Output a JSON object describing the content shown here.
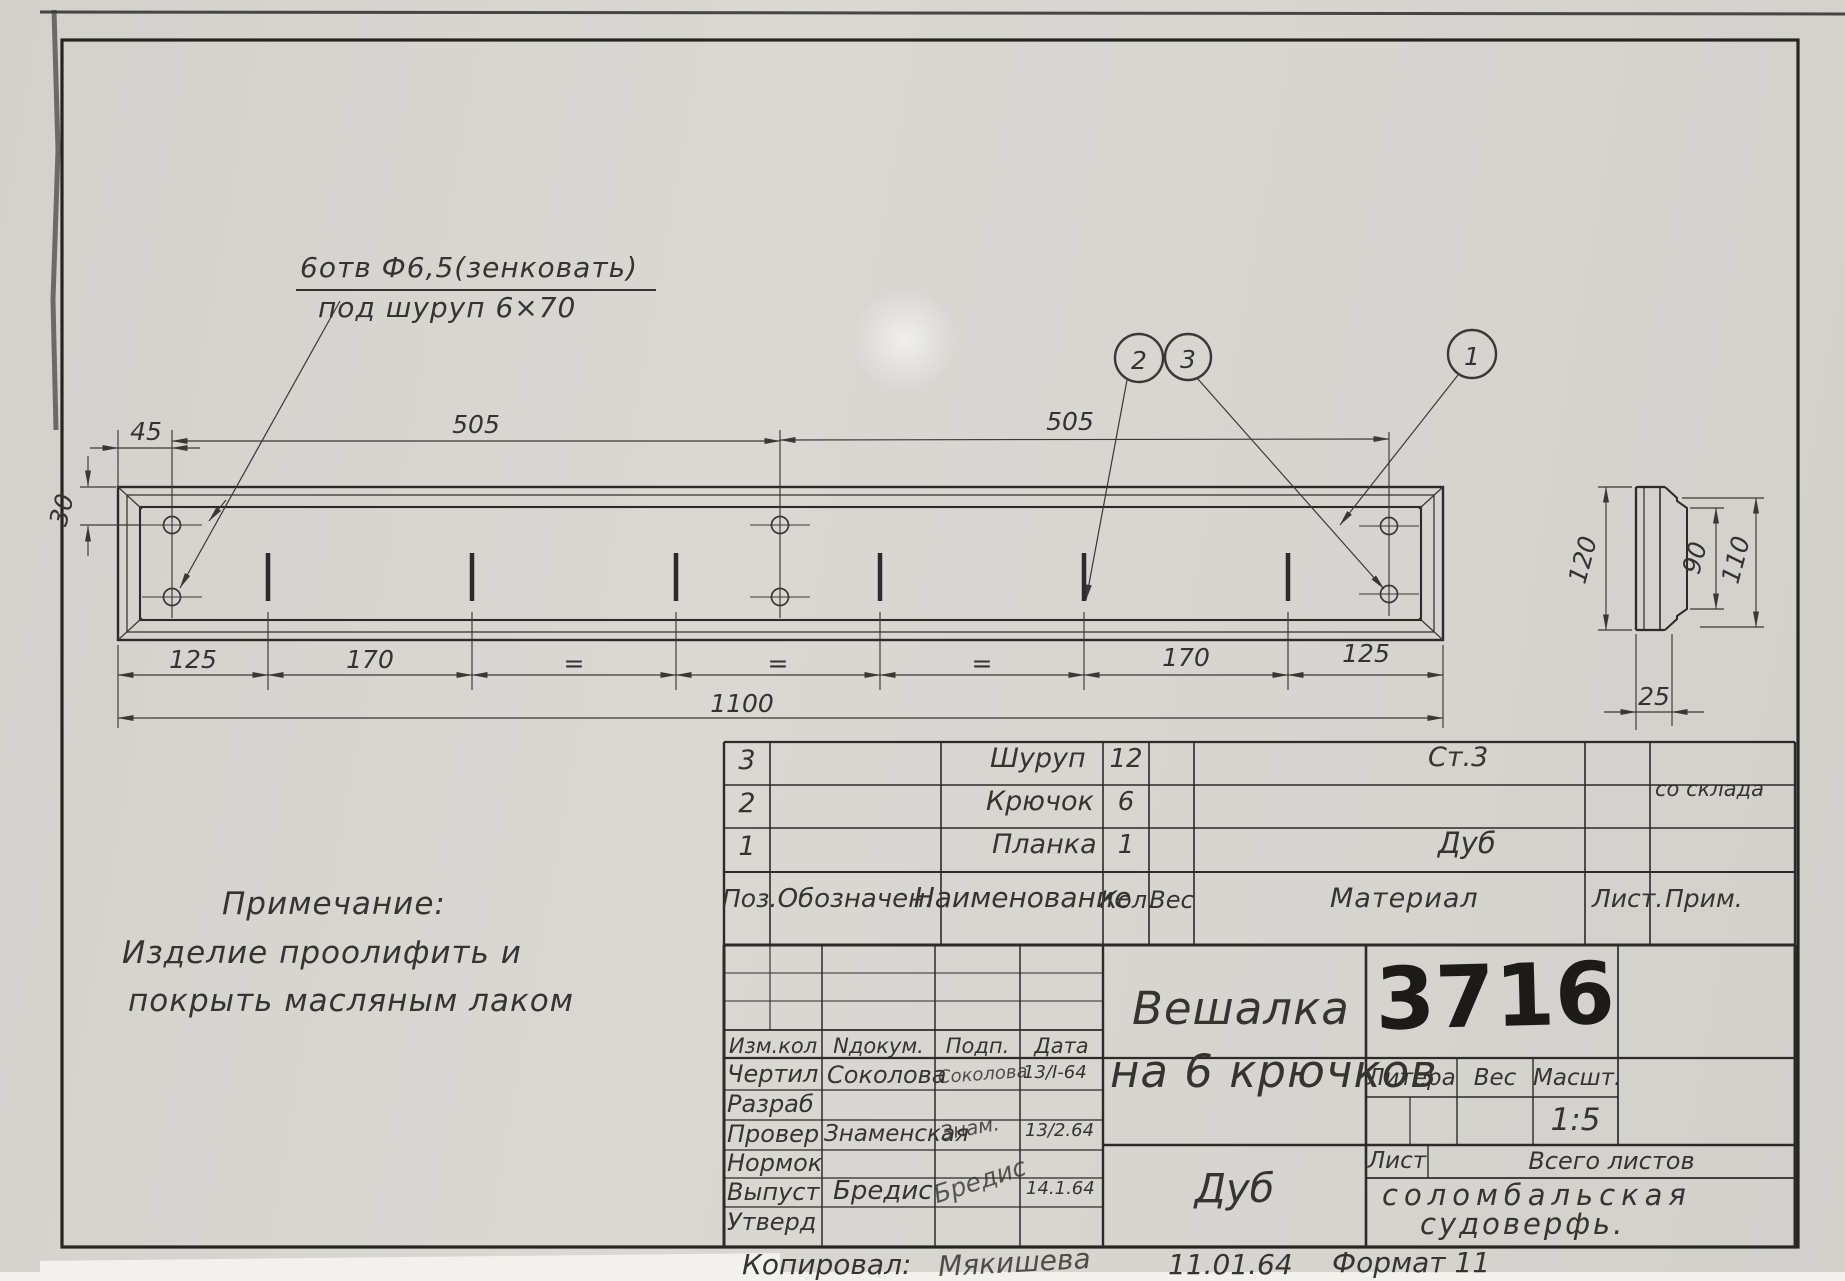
{
  "colors": {
    "paper": "#d7d5d0",
    "ink": "#3a3833",
    "heavy_ink": "#26251f"
  },
  "annotation": {
    "line1": "6отв Ф6,5(зенковать)",
    "line2": "под шуруп 6×70"
  },
  "callouts": {
    "c1": "1",
    "c2": "2",
    "c3": "3"
  },
  "dims": {
    "d45": "45",
    "d505_left": "505",
    "d505_right": "505",
    "d30": "30",
    "d125_left": "125",
    "d170_left": "170",
    "eq1": "=",
    "eq2": "=",
    "eq3": "=",
    "d170_right": "170",
    "d125_right": "125",
    "d1100": "1100",
    "d120": "120",
    "d90": "90",
    "d110": "110",
    "d25": "25"
  },
  "note": {
    "title": "Примечание:",
    "line1": "Изделие проолифить и",
    "line2": "покрыть масляным лаком"
  },
  "parts": {
    "headers": {
      "pos": "Поз.",
      "designation": "Обозначен.",
      "name": "Наименование",
      "qty": "Кол.",
      "weight": "Вес",
      "material": "Материал",
      "sheet": "Лист.",
      "note": "Прим."
    },
    "rows": [
      {
        "pos": "3",
        "name": "Шуруп",
        "qty": "12",
        "material": "Ст.3",
        "note": ""
      },
      {
        "pos": "2",
        "name": "Крючок",
        "qty": "6",
        "material": "",
        "note": "со склада"
      },
      {
        "pos": "1",
        "name": "Планка",
        "qty": "1",
        "material": "Дуб",
        "note": ""
      }
    ]
  },
  "titleblock": {
    "rev_headers": {
      "izm": "Изм.кол",
      "ndok": "Nдокум.",
      "podp": "Подп.",
      "data": "Дата"
    },
    "sign_rows": [
      {
        "role": "Чертил",
        "name": "Соколова",
        "sig": "Соколова",
        "date": "13/I-64"
      },
      {
        "role": "Разраб",
        "name": "",
        "sig": "",
        "date": ""
      },
      {
        "role": "Провер",
        "name": "Знаменская",
        "sig": "Знам.",
        "date": "13/2.64"
      },
      {
        "role": "Нормок",
        "name": "",
        "sig": "",
        "date": ""
      },
      {
        "role": "Выпуст",
        "name": "Бредис",
        "sig": "Бредис",
        "date": "14.1.64"
      },
      {
        "role": "Утверд",
        "name": "",
        "sig": "",
        "date": ""
      }
    ],
    "title_line1": "Вешалка",
    "title_line2": "на 6 крючков",
    "material": "Дуб",
    "number": "3716",
    "litera": "Литера",
    "ves": "Вес",
    "masht": "Масшт.",
    "scale": "1:5",
    "list": "Лист",
    "vsego": "Всего листов",
    "org_line1": "соломбальская",
    "org_line2": "судоверфь."
  },
  "footer": {
    "copied": "Копировал:",
    "copied_name": "Мякишева",
    "date": "11.01.64",
    "format": "Формат 11"
  }
}
